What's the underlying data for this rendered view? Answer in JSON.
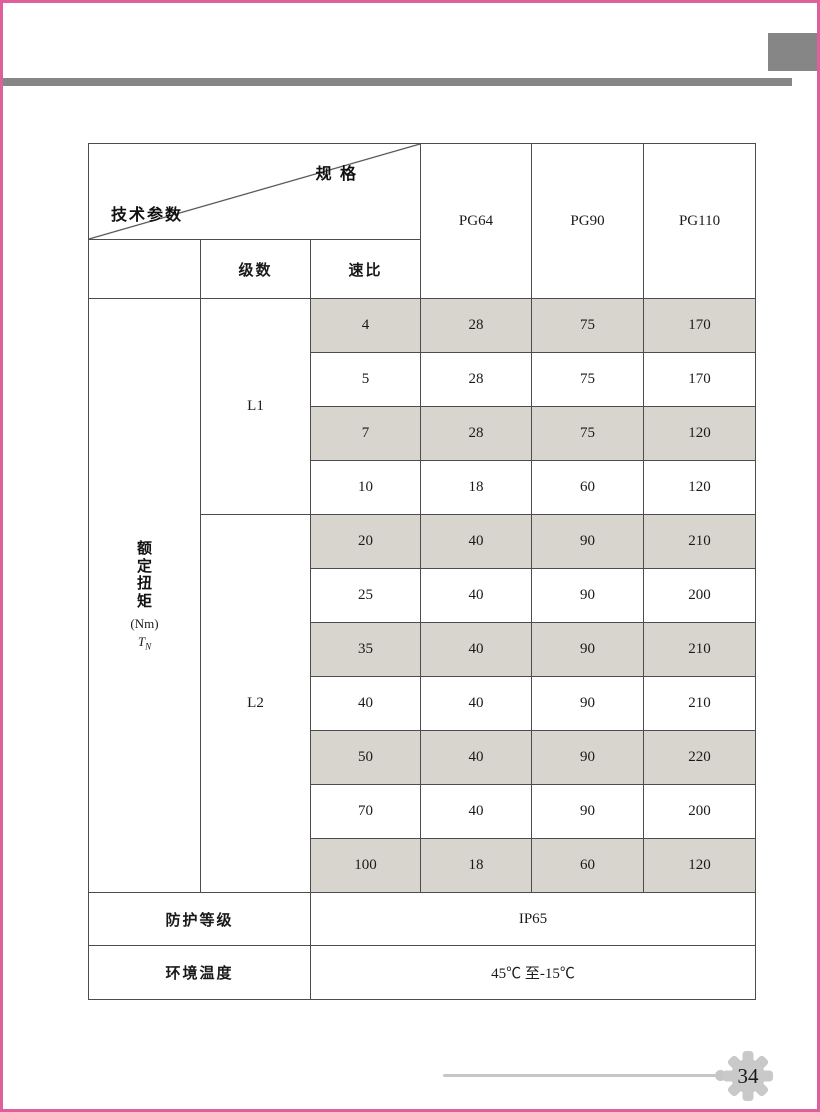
{
  "frame": {
    "accent_pink": "#dd5f9c",
    "decor_gray": "#868686",
    "cell_gray": "#d8d4ce"
  },
  "table": {
    "corner": {
      "top_label": "规 格",
      "bottom_label": "技术参数"
    },
    "columns": [
      "PG64",
      "PG90",
      "PG110"
    ],
    "sub_headers": {
      "stages": "级数",
      "ratio": "速比"
    },
    "torque": {
      "label_vertical": "额\n定\n扭\n矩",
      "unit": "(Nm)",
      "symbol": "T",
      "symbol_sub": "N"
    },
    "groups": [
      {
        "stage": "L1",
        "rows": [
          {
            "ratio": "4",
            "pg64": "28",
            "pg90": "75",
            "pg110": "170"
          },
          {
            "ratio": "5",
            "pg64": "28",
            "pg90": "75",
            "pg110": "170"
          },
          {
            "ratio": "7",
            "pg64": "28",
            "pg90": "75",
            "pg110": "120"
          },
          {
            "ratio": "10",
            "pg64": "18",
            "pg90": "60",
            "pg110": "120"
          }
        ]
      },
      {
        "stage": "L2",
        "rows": [
          {
            "ratio": "20",
            "pg64": "40",
            "pg90": "90",
            "pg110": "210"
          },
          {
            "ratio": "25",
            "pg64": "40",
            "pg90": "90",
            "pg110": "200"
          },
          {
            "ratio": "35",
            "pg64": "40",
            "pg90": "90",
            "pg110": "210"
          },
          {
            "ratio": "40",
            "pg64": "40",
            "pg90": "90",
            "pg110": "210"
          },
          {
            "ratio": "50",
            "pg64": "40",
            "pg90": "90",
            "pg110": "220"
          },
          {
            "ratio": "70",
            "pg64": "40",
            "pg90": "90",
            "pg110": "200"
          },
          {
            "ratio": "100",
            "pg64": "18",
            "pg90": "60",
            "pg110": "120"
          }
        ]
      }
    ],
    "footer_rows": [
      {
        "label": "防护等级",
        "value": "IP65"
      },
      {
        "label": "环境温度",
        "value": "45℃ 至-15℃"
      }
    ]
  },
  "footer": {
    "page_number": "34"
  }
}
